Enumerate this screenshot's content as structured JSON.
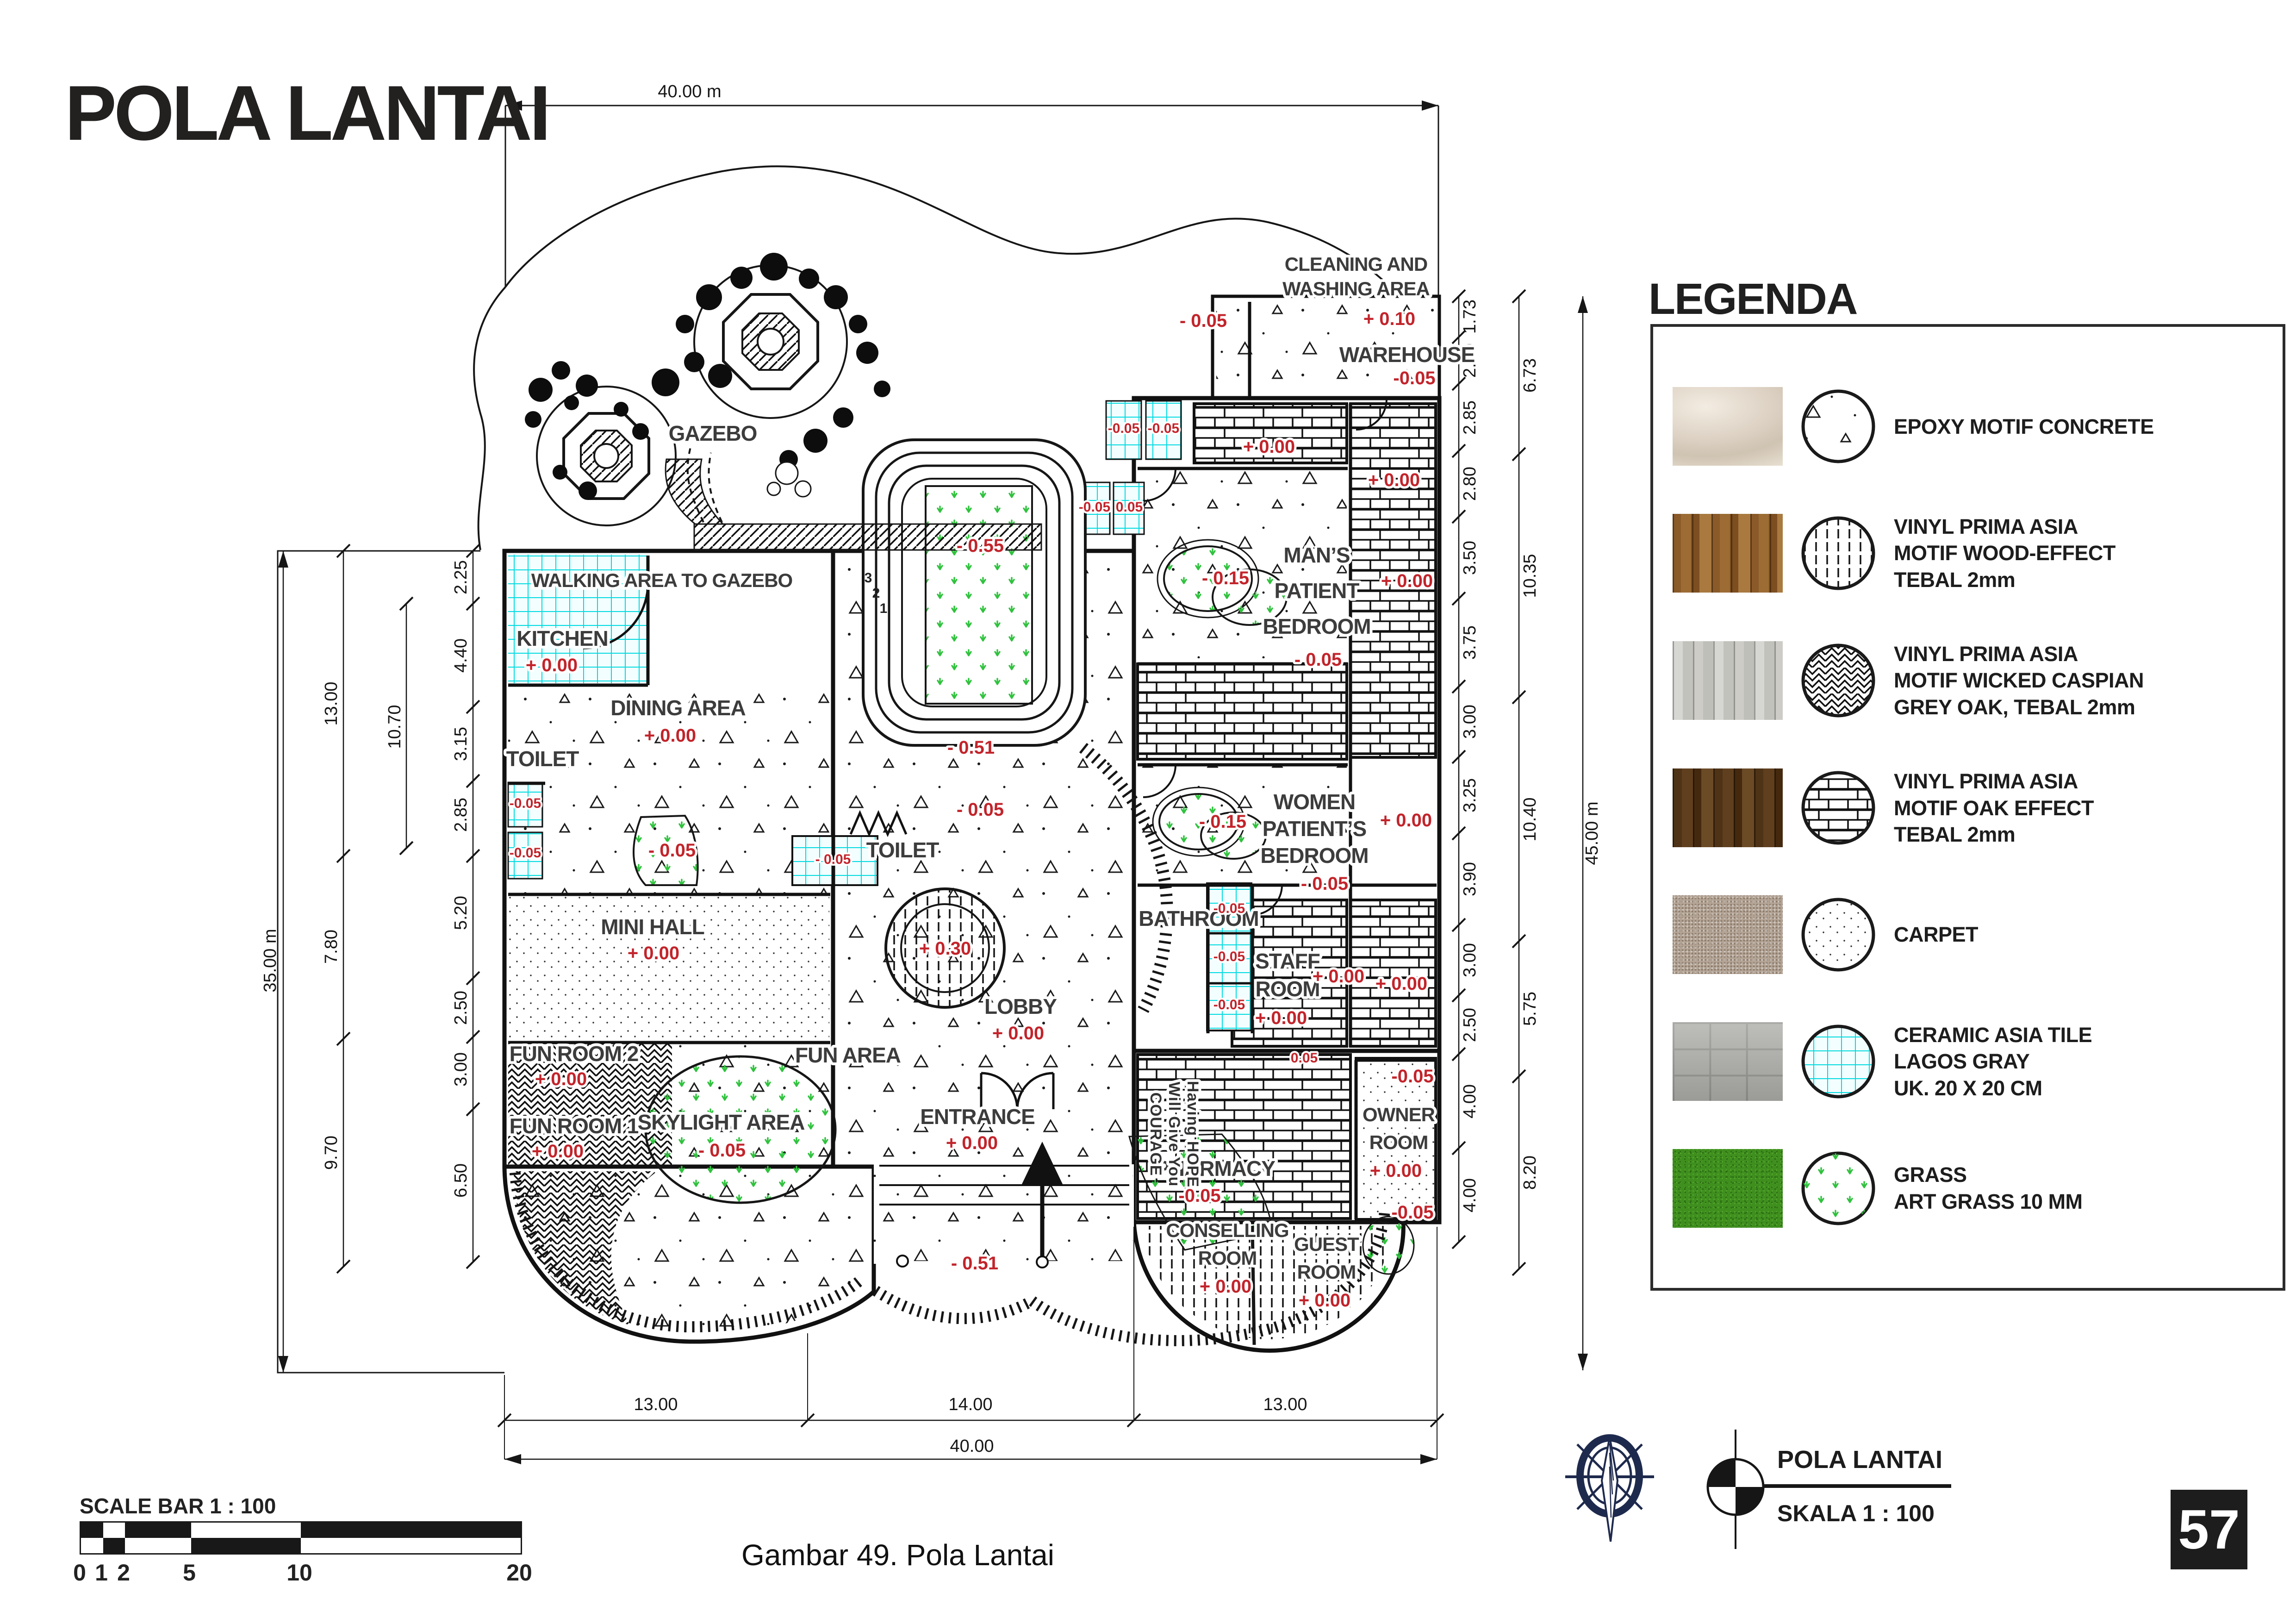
{
  "header": {
    "title": "POLA LANTAI"
  },
  "caption": "Gambar 49. Pola Lantai",
  "page_number": "57",
  "scale_bar": {
    "title": "SCALE BAR 1 : 100",
    "ticks": [
      "0",
      "1",
      "2",
      "5",
      "10",
      "20"
    ]
  },
  "title_block": {
    "drawing_name": "POLA LANTAI",
    "scale_label": "SKALA 1 : 100"
  },
  "legend": {
    "title": "LEGENDA",
    "items": [
      {
        "name": "epoxy-motif-concrete",
        "label": "EPOXY MOTIF CONCRETE"
      },
      {
        "name": "vinyl-wood-effect",
        "label": "VINYL PRIMA ASIA\nMOTIF WOOD-EFFECT\nTEBAL 2mm"
      },
      {
        "name": "vinyl-wicked-caspian",
        "label": "VINYL PRIMA ASIA\nMOTIF WICKED CASPIAN\nGREY OAK, TEBAL 2mm"
      },
      {
        "name": "vinyl-oak-effect",
        "label": "VINYL PRIMA ASIA\nMOTIF OAK EFFECT\nTEBAL 2mm"
      },
      {
        "name": "carpet",
        "label": "CARPET"
      },
      {
        "name": "ceramic-lagos-gray",
        "label": "CERAMIC ASIA TILE\nLAGOS GRAY\nUK. 20 X 20 CM"
      },
      {
        "name": "art-grass",
        "label": "GRASS\nART GRASS 10 MM"
      }
    ]
  },
  "plan": {
    "labels": {
      "cleaning_1": "CLEANING AND",
      "cleaning_2": "WASHING AREA",
      "warehouse": "WAREHOUSE",
      "gazebo": "GAZEBO",
      "walking": "WALKING AREA TO GAZEBO",
      "kitchen": "KITCHEN",
      "dining": "DINING AREA",
      "toilet_left": "TOILET",
      "toilet_mid": "TOILET",
      "mans_1": "MAN’S",
      "mans_2": "PATIENT",
      "mans_3": "BEDROOM",
      "women_1": "WOMEN",
      "women_2": "PATIENT’S",
      "women_3": "BEDROOM",
      "bathroom": "BATHROOM",
      "staff_1": "STAFF",
      "staff_2": "ROOM",
      "minihall": "MINI HALL",
      "lobby": "LOBBY",
      "funroom2": "FUN ROOM 2",
      "funarea": "FUN AREA",
      "funroom1": "FUN ROOM 1",
      "skylight": "SKYLIGHT AREA",
      "entrance": "ENTRANCE",
      "pharmacy": "PHARMACY",
      "conselling_1": "CONSELLING",
      "conselling_2": "ROOM",
      "guest_1": "GUEST",
      "guest_2": "ROOM",
      "owner_1": "OWNER",
      "owner_2": "ROOM",
      "quote_1": "Having HOPE",
      "quote_2": "Will Give You",
      "quote_3": "COURAGE",
      "step_1": "1",
      "step_2": "2",
      "step_3": "3"
    },
    "levels": {
      "p000": "+ 0.00",
      "m005": "- 0.05",
      "m005c": "-0.05",
      "p010": "+ 0.10",
      "m015": "- 0.15",
      "m051": "- 0.51",
      "m055": "- 0.55",
      "p030": "+ 0.30",
      "p005": "0.05"
    },
    "dims": {
      "top_total": "40.00 m",
      "bottom": [
        "13.00",
        "14.00",
        "13.00"
      ],
      "bottom_total": "40.00",
      "left_total": "35.00 m",
      "left_groups": [
        "13.00",
        "7.80",
        "9.70"
      ],
      "left_mid": "10.70",
      "left_inner": [
        "2.25",
        "4.40",
        "3.15",
        "2.85",
        "5.20",
        "2.50",
        "3.00",
        "6.50"
      ],
      "right_total": "45.00 m",
      "right_groups": [
        "6.73",
        "10.35",
        "10.40",
        "5.75",
        "8.20"
      ],
      "right_inner": [
        "1.73",
        "2.00",
        "2.85",
        "2.80",
        "3.50",
        "3.75",
        "3.00",
        "3.25",
        "3.90",
        "3.00",
        "2.50",
        "4.00",
        "4.00"
      ]
    },
    "colors": {
      "level_red": "#c2242b",
      "tile_cyan": "#00dbe0",
      "grass_green": "#2fc23d",
      "ink": "#141414",
      "compass_navy": "#1e2a4d"
    }
  }
}
